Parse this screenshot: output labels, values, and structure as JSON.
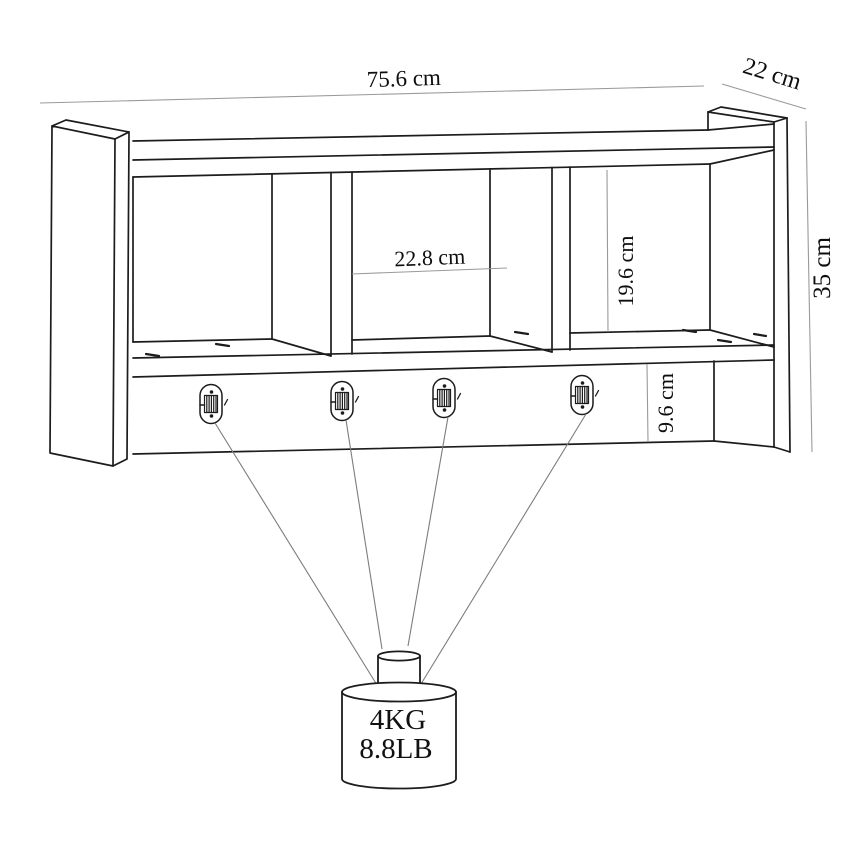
{
  "drawing": {
    "subject": "wall-mounted shelf with three compartments and four coat hooks",
    "view": "perspective technical line drawing with dimension callouts",
    "colors": {
      "outline": "#1c1c1c",
      "dimension_line": "#9a9a9a",
      "leader_line": "#7d7d7d",
      "text": "#0e0e0e",
      "background": "#ffffff"
    },
    "dimensions": {
      "overall_width": "75.6 cm",
      "overall_depth": "22 cm",
      "overall_height": "35 cm",
      "compartment_width": "22.8 cm",
      "compartment_height": "19.6 cm",
      "rail_height": "9.6 cm"
    },
    "weight_capacity": {
      "line1": "4KG",
      "line2": "8.8LB"
    },
    "hook_count": 4,
    "compartment_count": 3
  }
}
